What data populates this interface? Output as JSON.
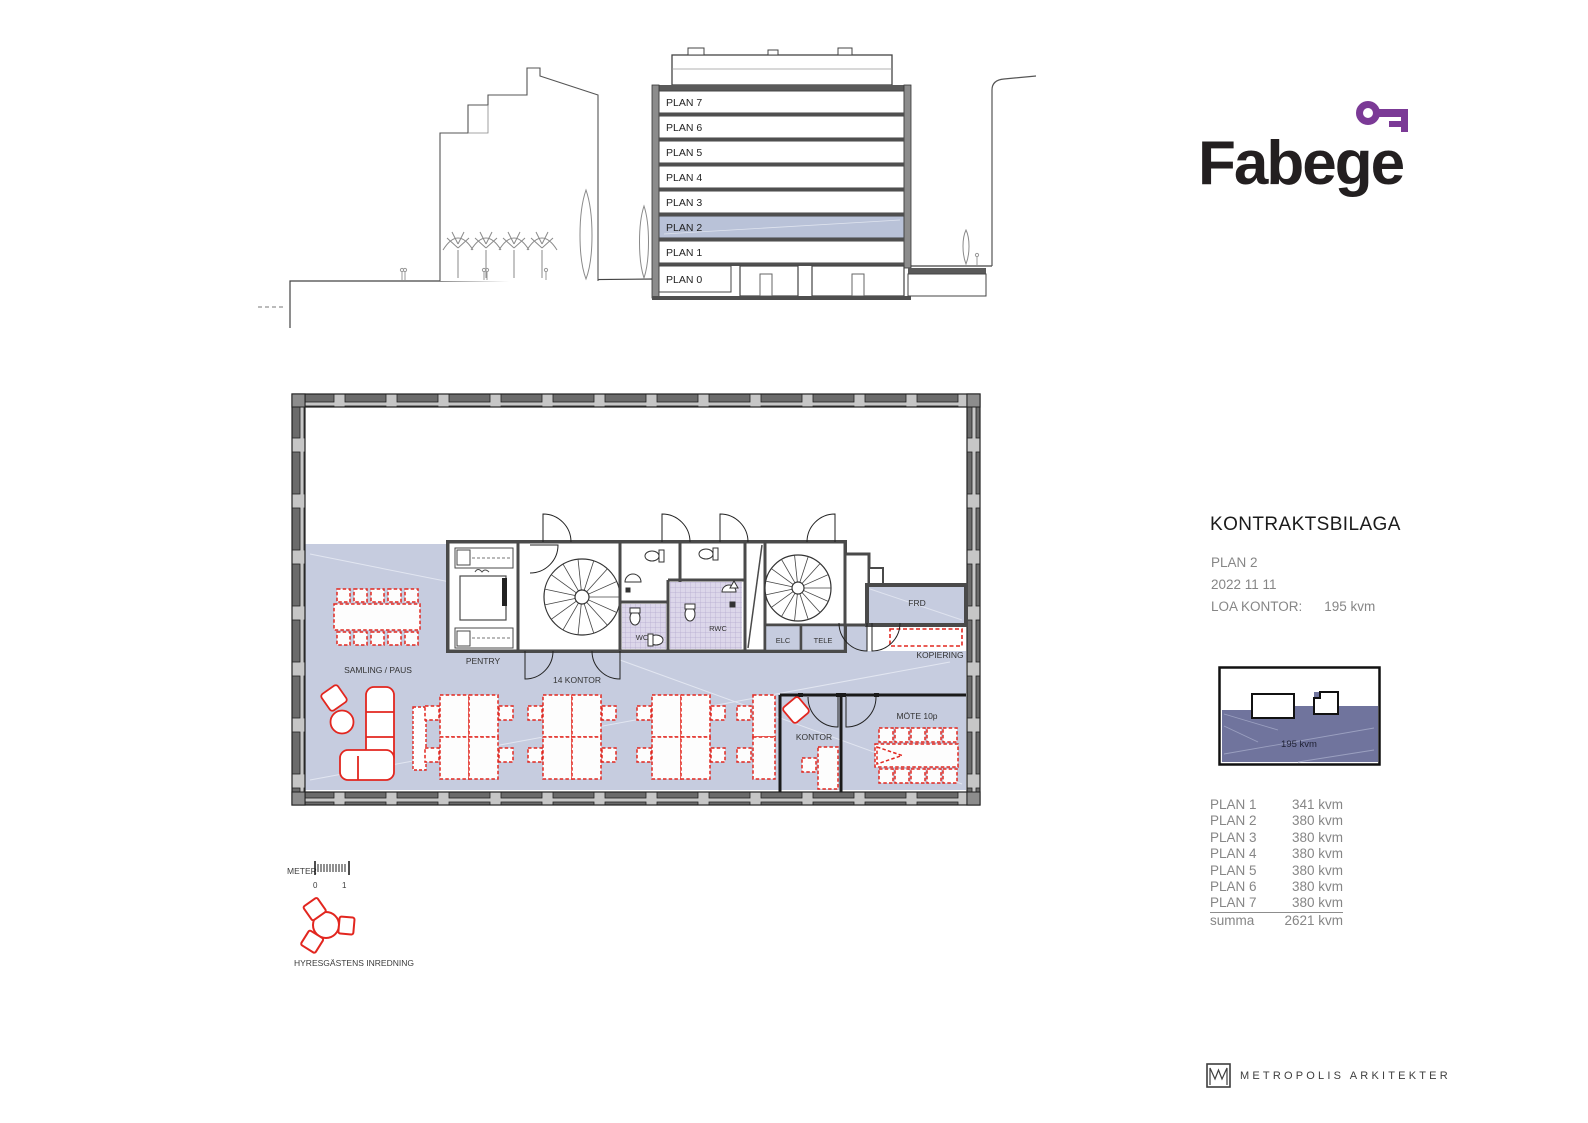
{
  "logo": {
    "brand": "Fabege"
  },
  "section": {
    "floors": [
      "PLAN 7",
      "PLAN 6",
      "PLAN 5",
      "PLAN 4",
      "PLAN 3",
      "PLAN 2",
      "PLAN 1",
      "PLAN 0"
    ],
    "highlighted_floor": "PLAN 2"
  },
  "contract": {
    "title": "KONTRAKTSBILAGA",
    "plan": "PLAN 2",
    "date": "2022 11 11",
    "loa_label": "LOA KONTOR:",
    "loa_value": "195 kvm"
  },
  "keyplan": {
    "area_label": "195 kvm"
  },
  "area_table": {
    "rows": [
      {
        "label": "PLAN 1",
        "value": "341 kvm"
      },
      {
        "label": "PLAN 2",
        "value": "380 kvm"
      },
      {
        "label": "PLAN 3",
        "value": "380 kvm"
      },
      {
        "label": "PLAN 4",
        "value": "380 kvm"
      },
      {
        "label": "PLAN 5",
        "value": "380 kvm"
      },
      {
        "label": "PLAN 6",
        "value": "380 kvm"
      },
      {
        "label": "PLAN 7",
        "value": "380 kvm"
      }
    ],
    "total": {
      "label": "summa",
      "value": "2621 kvm"
    }
  },
  "floorplan": {
    "rooms": {
      "samling": "SAMLING / PAUS",
      "pentry": "PENTRY",
      "open_office": "14 KONTOR",
      "wc": "WC",
      "rwc": "RWC",
      "elc": "ELC",
      "tele": "TELE",
      "frd": "FRD",
      "kopiering": "KOPIERING",
      "kontor": "KONTOR",
      "mote": "MÖTE 10p"
    },
    "scale": {
      "label": "METER",
      "start": "0",
      "end": "1"
    },
    "legend": {
      "label": "HYRESGÄSTENS INREDNING"
    }
  },
  "footer": {
    "architect": "METROPOLIS ARKITEKTER"
  },
  "colors": {
    "accent_purple": "#7b3a96",
    "lease_blue": "#c6ccdf",
    "highlight_blue": "#b9c2d8",
    "furniture_red": "#e2261f",
    "keyplan_purple": "#70749d"
  }
}
